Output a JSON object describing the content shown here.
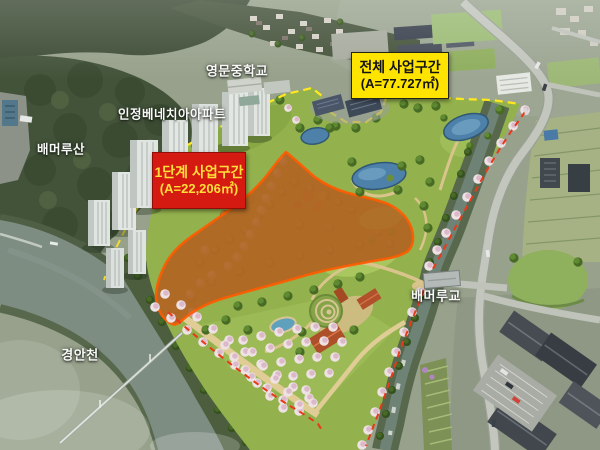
{
  "annotations": {
    "total_zone": {
      "title": "전체 사업구간",
      "area": "(A=77.727㎡)",
      "bg_color": "#ffe400",
      "text_color": "#141414"
    },
    "phase1_zone": {
      "title": "1단계 사업구간",
      "area": "(A=22,206㎡)",
      "bg_color": "#d51a12",
      "text_color": "#ffdf3a",
      "boundary_color": "#ff5c00"
    }
  },
  "place_labels": {
    "school": "영문중학교",
    "apartment": "인정베네치아아파트",
    "mountain": "배머루산",
    "stream": "경안천",
    "bridge": "배머루교"
  },
  "boundary_colors": {
    "total_boundary": "#ffe81e",
    "phase1_boundary": "#ff5c00",
    "route_dash": "#e8391a"
  }
}
